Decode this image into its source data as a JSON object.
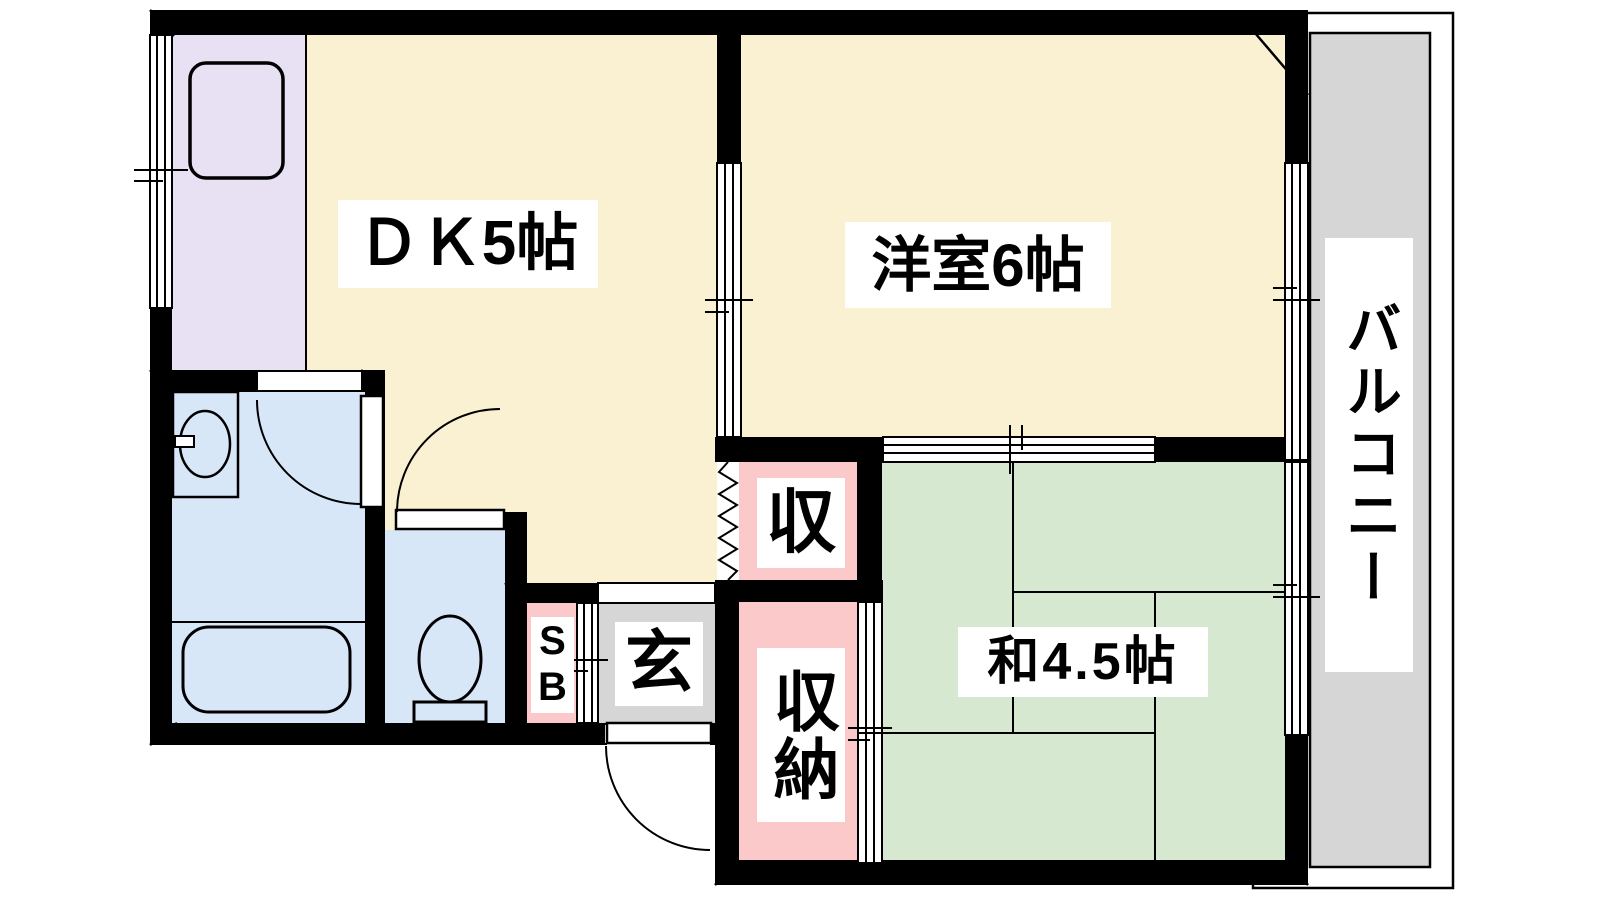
{
  "floorplan": {
    "type": "apartment-floorplan",
    "wall_color": "#000000",
    "line_color": "#000000",
    "labels": {
      "dk": "ＤＫ5帖",
      "western_room": "洋室6帖",
      "japanese_room": "和4.5帖",
      "balcony": "バルコニー",
      "genkan": "玄",
      "closet_upper": "収",
      "closet_lower": "収納",
      "shoe_box": "SB"
    },
    "colors": {
      "cream": "#FAF0D2",
      "kitchen": "#E8E0F3",
      "tatami": "#D6E8D0",
      "storage": "#FBC9C9",
      "water": "#D8E7F8",
      "gray": "#D6D6D6",
      "balcony_floor": "#D6D6D6",
      "label_bg": "#FFFFFF"
    }
  }
}
